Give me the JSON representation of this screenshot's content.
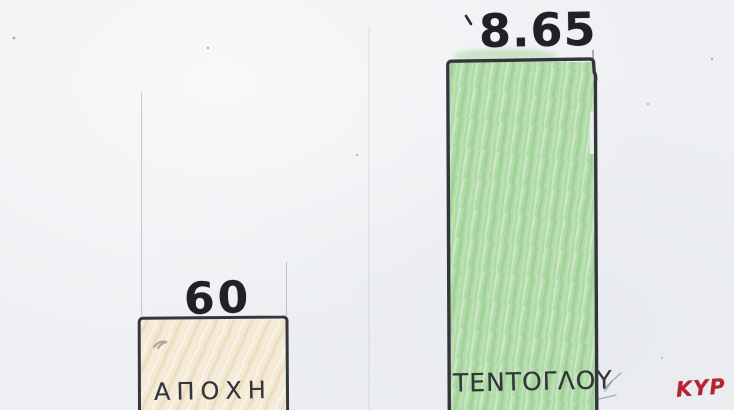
{
  "page": {
    "background_color": "#eef0f3",
    "medium": "hand-drawn crayon and pencil bar chart on scanned paper"
  },
  "chart_data": {
    "type": "bar",
    "categories": [
      "ΑΠΟΧΗ",
      "ΤΕΝΤΟΓΛΟΥ"
    ],
    "values": [
      60,
      8.65
    ],
    "value_labels": [
      "60",
      "8.65"
    ],
    "bar_fill_colors": [
      "#f2e7d1",
      "#a9d7a0"
    ],
    "outline_color": "#35373b",
    "title": "",
    "xlabel": "",
    "ylabel": "",
    "axes_visible": false,
    "gridlines": false,
    "legend": false,
    "orientation": "vertical",
    "note_visual": "taller bar carries the smaller printed value 8.65; shorter bar carries 60"
  },
  "annotations": {
    "signature": {
      "text": "ΚΥΡ",
      "color": "#b5232f"
    }
  }
}
